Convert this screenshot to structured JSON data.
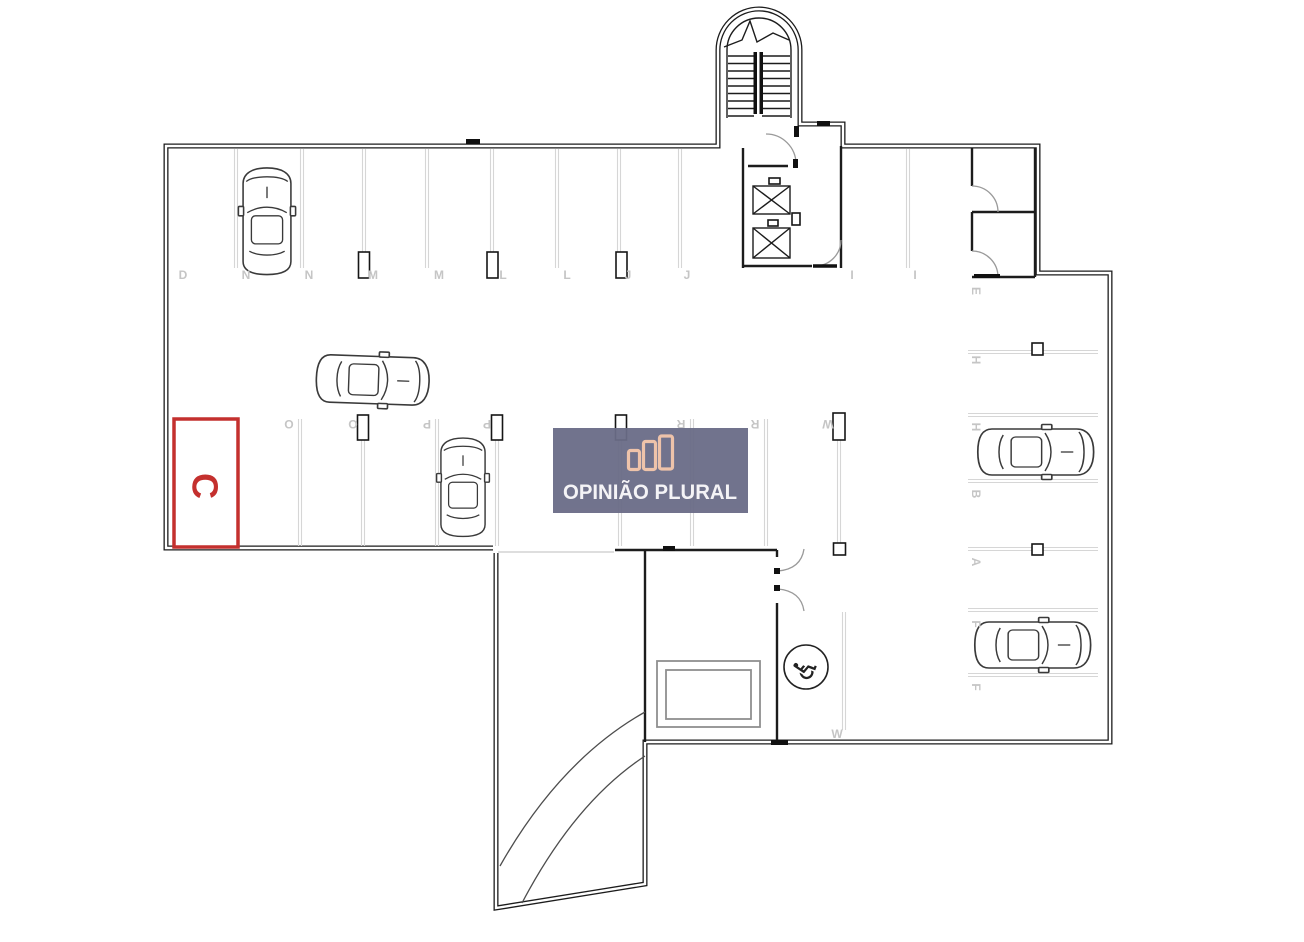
{
  "plan": {
    "watermark": {
      "text": "OPINIÃO PLURAL",
      "bg_color": "#6a6c87",
      "bars_color": "#eec0a6",
      "text_color": "#f4f3f6"
    },
    "highlighted_space": {
      "label": "C",
      "color": "#c4302e"
    },
    "parking_labels": {
      "top_row": [
        "D",
        "N",
        "N",
        "M",
        "M",
        "L",
        "L",
        "J",
        "J"
      ],
      "top_row_right": [
        "I",
        "I"
      ],
      "middle_row": [
        "O",
        "O",
        "P",
        "P",
        "R",
        "R",
        "W"
      ],
      "right_column": [
        "E",
        "H",
        "H",
        "B",
        "A",
        "F",
        "F"
      ],
      "bottom_space": "W"
    },
    "icons": {
      "wheelchair_glyph": "♿"
    }
  }
}
